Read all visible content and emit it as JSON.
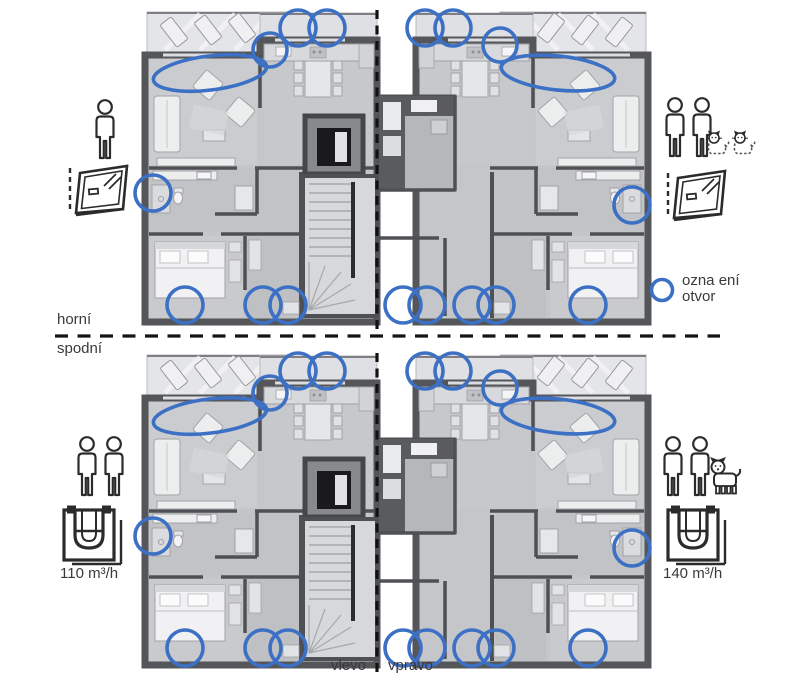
{
  "figure": {
    "divider_labels": {
      "above": "horní",
      "below": "spodní",
      "left": "vlevo",
      "right": "vpravo"
    },
    "legend": {
      "text_line1": "ozna ení",
      "text_line2": "otvor"
    },
    "quadrants": {
      "top_left": {
        "occupants": "1-adult",
        "pets": "none",
        "device": "tilted-window",
        "flow_label": ""
      },
      "top_right": {
        "occupants": "2-adults",
        "pets": "2-cats",
        "device": "tilted-window",
        "flow_label": ""
      },
      "bottom_left": {
        "occupants": "2-adults",
        "pets": "none",
        "device": "ventilation-unit",
        "flow_label": "110 m³/h"
      },
      "bottom_right": {
        "occupants": "2-adults",
        "pets": "1-dog",
        "device": "ventilation-unit",
        "flow_label": "140 m³/h"
      }
    },
    "colors": {
      "marker_blue": "#3b70c4",
      "wall_gray": "#55565a",
      "floor_gray": "#c5c6ca",
      "text": "#39393b"
    },
    "markers_per_plan": [
      {
        "shape": "ellipse",
        "x": 65,
        "y": 63,
        "rx": 57,
        "ry": 17,
        "rot": -7
      },
      {
        "shape": "circle",
        "x": 125,
        "y": 40,
        "r": 17
      },
      {
        "shape": "circle",
        "x": 153,
        "y": 18,
        "r": 18
      },
      {
        "shape": "circle",
        "x": 182,
        "y": 18,
        "r": 18
      },
      {
        "shape": "circle",
        "x": 280,
        "y": 18,
        "r": 18
      },
      {
        "shape": "circle",
        "x": 308,
        "y": 18,
        "r": 18
      },
      {
        "shape": "circle",
        "x": 355,
        "y": 35,
        "r": 17
      },
      {
        "shape": "ellipse",
        "x": 413,
        "y": 63,
        "rx": 57,
        "ry": 17,
        "rot": 6
      },
      {
        "shape": "circle",
        "x": 8,
        "y": 183,
        "r": 18
      },
      {
        "shape": "circle",
        "x": 487,
        "y": 195,
        "r": 18
      },
      {
        "shape": "circle",
        "x": 40,
        "y": 295,
        "r": 18
      },
      {
        "shape": "circle",
        "x": 118,
        "y": 295,
        "r": 18
      },
      {
        "shape": "circle",
        "x": 143,
        "y": 295,
        "r": 18
      },
      {
        "shape": "circle",
        "x": 258,
        "y": 295,
        "r": 18
      },
      {
        "shape": "circle",
        "x": 282,
        "y": 295,
        "r": 18
      },
      {
        "shape": "circle",
        "x": 327,
        "y": 295,
        "r": 18
      },
      {
        "shape": "circle",
        "x": 351,
        "y": 295,
        "r": 18
      },
      {
        "shape": "circle",
        "x": 443,
        "y": 295,
        "r": 18
      }
    ]
  }
}
